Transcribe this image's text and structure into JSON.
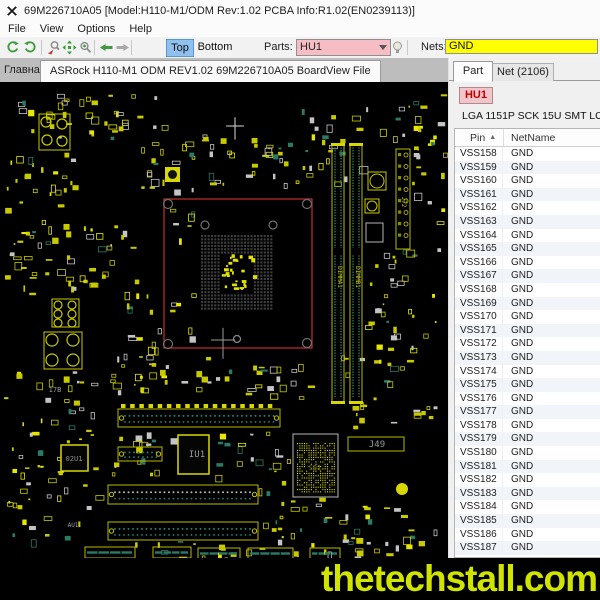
{
  "window": {
    "title": "69M226710A05 [Model:H110-M1/ODM Rev:1.02 PCBA Info:R1.02(EN0239113)]"
  },
  "menu": {
    "items": [
      "File",
      "View",
      "Options",
      "Help"
    ]
  },
  "toolbar": {
    "top": "Top",
    "bottom": "Bottom",
    "parts_label": "Parts:",
    "parts_value": "HU1",
    "nets_label": "Nets:",
    "nets_value": "GND"
  },
  "tabs": {
    "home": "Главная",
    "file": "ASRock H110-M1 ODM REV1.02 69M226710A05 BoardView File"
  },
  "panel": {
    "tab_part": "Part",
    "tab_net": "Net (2106)",
    "part_ref": "HU1",
    "part_desc": "LGA 1151P SCK 15U SMT LOTES",
    "columns": [
      "Pin",
      "NetName"
    ],
    "rows": [
      [
        "VSS158",
        "GND"
      ],
      [
        "VSS159",
        "GND"
      ],
      [
        "VSS160",
        "GND"
      ],
      [
        "VSS161",
        "GND"
      ],
      [
        "VSS162",
        "GND"
      ],
      [
        "VSS163",
        "GND"
      ],
      [
        "VSS164",
        "GND"
      ],
      [
        "VSS165",
        "GND"
      ],
      [
        "VSS166",
        "GND"
      ],
      [
        "VSS167",
        "GND"
      ],
      [
        "VSS168",
        "GND"
      ],
      [
        "VSS169",
        "GND"
      ],
      [
        "VSS170",
        "GND"
      ],
      [
        "VSS171",
        "GND"
      ],
      [
        "VSS172",
        "GND"
      ],
      [
        "VSS173",
        "GND"
      ],
      [
        "VSS174",
        "GND"
      ],
      [
        "VSS175",
        "GND"
      ],
      [
        "VSS176",
        "GND"
      ],
      [
        "VSS177",
        "GND"
      ],
      [
        "VSS178",
        "GND"
      ],
      [
        "VSS179",
        "GND"
      ],
      [
        "VSS180",
        "GND"
      ],
      [
        "VSS181",
        "GND"
      ],
      [
        "VSS182",
        "GND"
      ],
      [
        "VSS183",
        "GND"
      ],
      [
        "VSS184",
        "GND"
      ],
      [
        "VSS185",
        "GND"
      ],
      [
        "VSS186",
        "GND"
      ],
      [
        "VSS187",
        "GND"
      ]
    ]
  },
  "watermark": "thetechstall.com",
  "colors": {
    "parts_bg": "#f6bdc4",
    "nets_bg": "#ffff00",
    "top_active_bg": "#8fc0ee",
    "highlight_red": "#c43030",
    "board_yellow": "#c9c900",
    "part_ref_red": "#c00000",
    "watermark": "#d0e400"
  },
  "board": {
    "seed": 1337,
    "palette": {
      "yellow": "#c9c900",
      "bright": "#e6e600",
      "gray": "#c4c4c4",
      "teal": "#2a7a68"
    },
    "labels": [
      {
        "text": "IU1",
        "x": 197,
        "y": 375,
        "size": 9,
        "color": "#9a9a9a"
      },
      {
        "text": "02U1",
        "x": 74,
        "y": 379,
        "size": 7,
        "color": "#8a8a8a"
      },
      {
        "text": "J49",
        "x": 377,
        "y": 365,
        "size": 9,
        "color": "#9a9a9a"
      },
      {
        "text": "AU1",
        "x": 73,
        "y": 445,
        "size": 6,
        "color": "#9a9a9a"
      },
      {
        "text": "17B",
        "x": 55,
        "y": 310,
        "size": 7,
        "color": "#9a9a9a"
      },
      {
        "text": "SB1",
        "x": 315,
        "y": 388,
        "size": 7,
        "color": "#6b6b00"
      },
      {
        "text": "DIMMA1",
        "x": 338,
        "y": 195,
        "size": 6,
        "color": "#c9c900",
        "rot": 90
      },
      {
        "text": "DIMMB1",
        "x": 356,
        "y": 195,
        "size": 6,
        "color": "#c9c900",
        "rot": 90
      },
      {
        "text": "J72",
        "x": 402,
        "y": 120,
        "size": 6,
        "color": "#c9c900",
        "rot": 90
      }
    ],
    "features": [
      {
        "type": "cross",
        "x": 235,
        "y": 44,
        "len": 16,
        "color": "#d8d8d8"
      },
      {
        "type": "redrect",
        "x": 164,
        "y": 117,
        "w": 148,
        "h": 149
      },
      {
        "type": "pads",
        "x": 201,
        "y": 153,
        "cols": 22,
        "rows": 23,
        "pitch": 3.3,
        "size": 2.1,
        "color": "#3e3e3e",
        "hc1": 6,
        "hc2": 15,
        "hr1": 6,
        "hr2": 17
      },
      {
        "type": "centerbits",
        "x": 221,
        "y": 172,
        "w": 32,
        "h": 38,
        "n": 26,
        "color": "#e2e200"
      },
      {
        "type": "ring",
        "x": 168,
        "y": 122,
        "r": 4.5,
        "color": "#6f6f6f"
      },
      {
        "type": "ring",
        "x": 307,
        "y": 122,
        "r": 4.5,
        "color": "#6f6f6f"
      },
      {
        "type": "ring",
        "x": 307,
        "y": 261,
        "r": 4.5,
        "color": "#6f6f6f"
      },
      {
        "type": "ring",
        "x": 168,
        "y": 262,
        "r": 4.5,
        "color": "#6f6f6f"
      },
      {
        "type": "ring",
        "x": 205,
        "y": 143,
        "r": 4,
        "color": "#6f6f6f"
      },
      {
        "type": "ring",
        "x": 273,
        "y": 143,
        "r": 4,
        "color": "#6f6f6f"
      },
      {
        "type": "ring",
        "x": 237,
        "y": 257,
        "r": 3.5,
        "color": "#8a8a8a"
      },
      {
        "type": "cross",
        "x": 223,
        "y": 258,
        "len": 22,
        "color": "#9a9a9a"
      },
      {
        "type": "dimm",
        "x": 332,
        "y": 63,
        "w": 12,
        "h": 257
      },
      {
        "type": "dimm",
        "x": 350,
        "y": 63,
        "w": 12,
        "h": 257
      },
      {
        "type": "vconn",
        "x": 396,
        "y": 67,
        "w": 14,
        "h": 100,
        "n": 8
      },
      {
        "type": "circsq",
        "x": 377,
        "y": 99,
        "r": 7
      },
      {
        "type": "circsq",
        "x": 372,
        "y": 124,
        "r": 5
      },
      {
        "type": "grayrect",
        "x": 366,
        "y": 141,
        "w": 17,
        "h": 19
      },
      {
        "type": "hslot",
        "x": 118,
        "y": 327,
        "w": 162,
        "h": 18,
        "dot": "#2a7a68",
        "tabs": true
      },
      {
        "type": "hslot",
        "x": 118,
        "y": 365,
        "w": 44,
        "h": 14,
        "dot": "#2a7a68",
        "tabs": false
      },
      {
        "type": "hslot",
        "x": 108,
        "y": 403,
        "w": 150,
        "h": 19,
        "dot": "#b9b9b9",
        "tabs": false
      },
      {
        "type": "hslot",
        "x": 108,
        "y": 440,
        "w": 150,
        "h": 18,
        "dot": "#2a7a68",
        "tabs": false
      },
      {
        "type": "chip",
        "x": 178,
        "y": 353,
        "w": 31,
        "h": 39
      },
      {
        "type": "chip",
        "x": 61,
        "y": 363,
        "w": 27,
        "h": 26
      },
      {
        "type": "bga",
        "x": 293,
        "y": 352,
        "w": 45,
        "h": 63
      },
      {
        "type": "labelbox",
        "x": 348,
        "y": 355,
        "w": 56,
        "h": 14
      },
      {
        "type": "block",
        "x": 39,
        "y": 32,
        "w": 31,
        "h": 36,
        "rings": [
          [
            7,
            8,
            5
          ],
          [
            23,
            10,
            5
          ],
          [
            8,
            26,
            5
          ],
          [
            23,
            27,
            5
          ]
        ]
      },
      {
        "type": "block",
        "x": 52,
        "y": 217,
        "w": 27,
        "h": 28,
        "rings": [
          [
            6,
            6,
            4
          ],
          [
            20,
            6,
            4
          ],
          [
            6,
            15,
            4
          ],
          [
            20,
            15,
            4
          ],
          [
            6,
            24,
            4
          ],
          [
            20,
            24,
            4
          ]
        ]
      },
      {
        "type": "block",
        "x": 44,
        "y": 250,
        "w": 38,
        "h": 37,
        "rings": [
          [
            8,
            8,
            6
          ],
          [
            29,
            8,
            6
          ],
          [
            8,
            28,
            6
          ],
          [
            29,
            28,
            6
          ]
        ]
      },
      {
        "type": "padbox",
        "x": 165,
        "y": 85,
        "w": 15,
        "h": 15
      },
      {
        "type": "dot",
        "x": 402,
        "y": 407,
        "r": 6,
        "color": "#d8d800"
      },
      {
        "type": "bstrip",
        "x": 85,
        "y": 465,
        "w": 50,
        "h": 11
      },
      {
        "type": "bstrip",
        "x": 153,
        "y": 465,
        "w": 38,
        "h": 11
      },
      {
        "type": "bstrip",
        "x": 198,
        "y": 466,
        "w": 42,
        "h": 11
      },
      {
        "type": "bstrip",
        "x": 248,
        "y": 466,
        "w": 45,
        "h": 11
      },
      {
        "type": "bstrip",
        "x": 310,
        "y": 466,
        "w": 30,
        "h": 11
      }
    ],
    "clusters": [
      {
        "x": 75,
        "y": 8,
        "w": 90,
        "h": 55,
        "n": 24
      },
      {
        "x": 4,
        "y": 8,
        "w": 66,
        "h": 55,
        "n": 16
      },
      {
        "x": 4,
        "y": 70,
        "w": 70,
        "h": 80,
        "n": 30
      },
      {
        "x": 140,
        "y": 52,
        "w": 75,
        "h": 58,
        "n": 26
      },
      {
        "x": 215,
        "y": 55,
        "w": 75,
        "h": 50,
        "n": 22
      },
      {
        "x": 290,
        "y": 22,
        "w": 72,
        "h": 78,
        "n": 24
      },
      {
        "x": 4,
        "y": 152,
        "w": 70,
        "h": 62,
        "n": 26
      },
      {
        "x": 78,
        "y": 140,
        "w": 58,
        "h": 62,
        "n": 20
      },
      {
        "x": 363,
        "y": 12,
        "w": 80,
        "h": 50,
        "n": 20
      },
      {
        "x": 412,
        "y": 62,
        "w": 32,
        "h": 110,
        "n": 14
      },
      {
        "x": 363,
        "y": 168,
        "w": 80,
        "h": 78,
        "n": 26
      },
      {
        "x": 4,
        "y": 288,
        "w": 92,
        "h": 88,
        "n": 32
      },
      {
        "x": 100,
        "y": 270,
        "w": 130,
        "h": 44,
        "n": 30
      },
      {
        "x": 240,
        "y": 282,
        "w": 80,
        "h": 34,
        "n": 18
      },
      {
        "x": 340,
        "y": 250,
        "w": 104,
        "h": 96,
        "n": 34
      },
      {
        "x": 100,
        "y": 350,
        "w": 72,
        "h": 42,
        "n": 16
      },
      {
        "x": 212,
        "y": 348,
        "w": 76,
        "h": 46,
        "n": 18
      },
      {
        "x": 4,
        "y": 382,
        "w": 92,
        "h": 78,
        "n": 30
      },
      {
        "x": 258,
        "y": 392,
        "w": 86,
        "h": 68,
        "n": 26
      },
      {
        "x": 345,
        "y": 420,
        "w": 98,
        "h": 52,
        "n": 24
      },
      {
        "x": 100,
        "y": 458,
        "w": 260,
        "h": 32,
        "n": 36
      },
      {
        "x": 166,
        "y": 124,
        "w": 28,
        "h": 132,
        "n": 12
      },
      {
        "x": 120,
        "y": 210,
        "w": 44,
        "h": 56,
        "n": 14
      }
    ]
  }
}
